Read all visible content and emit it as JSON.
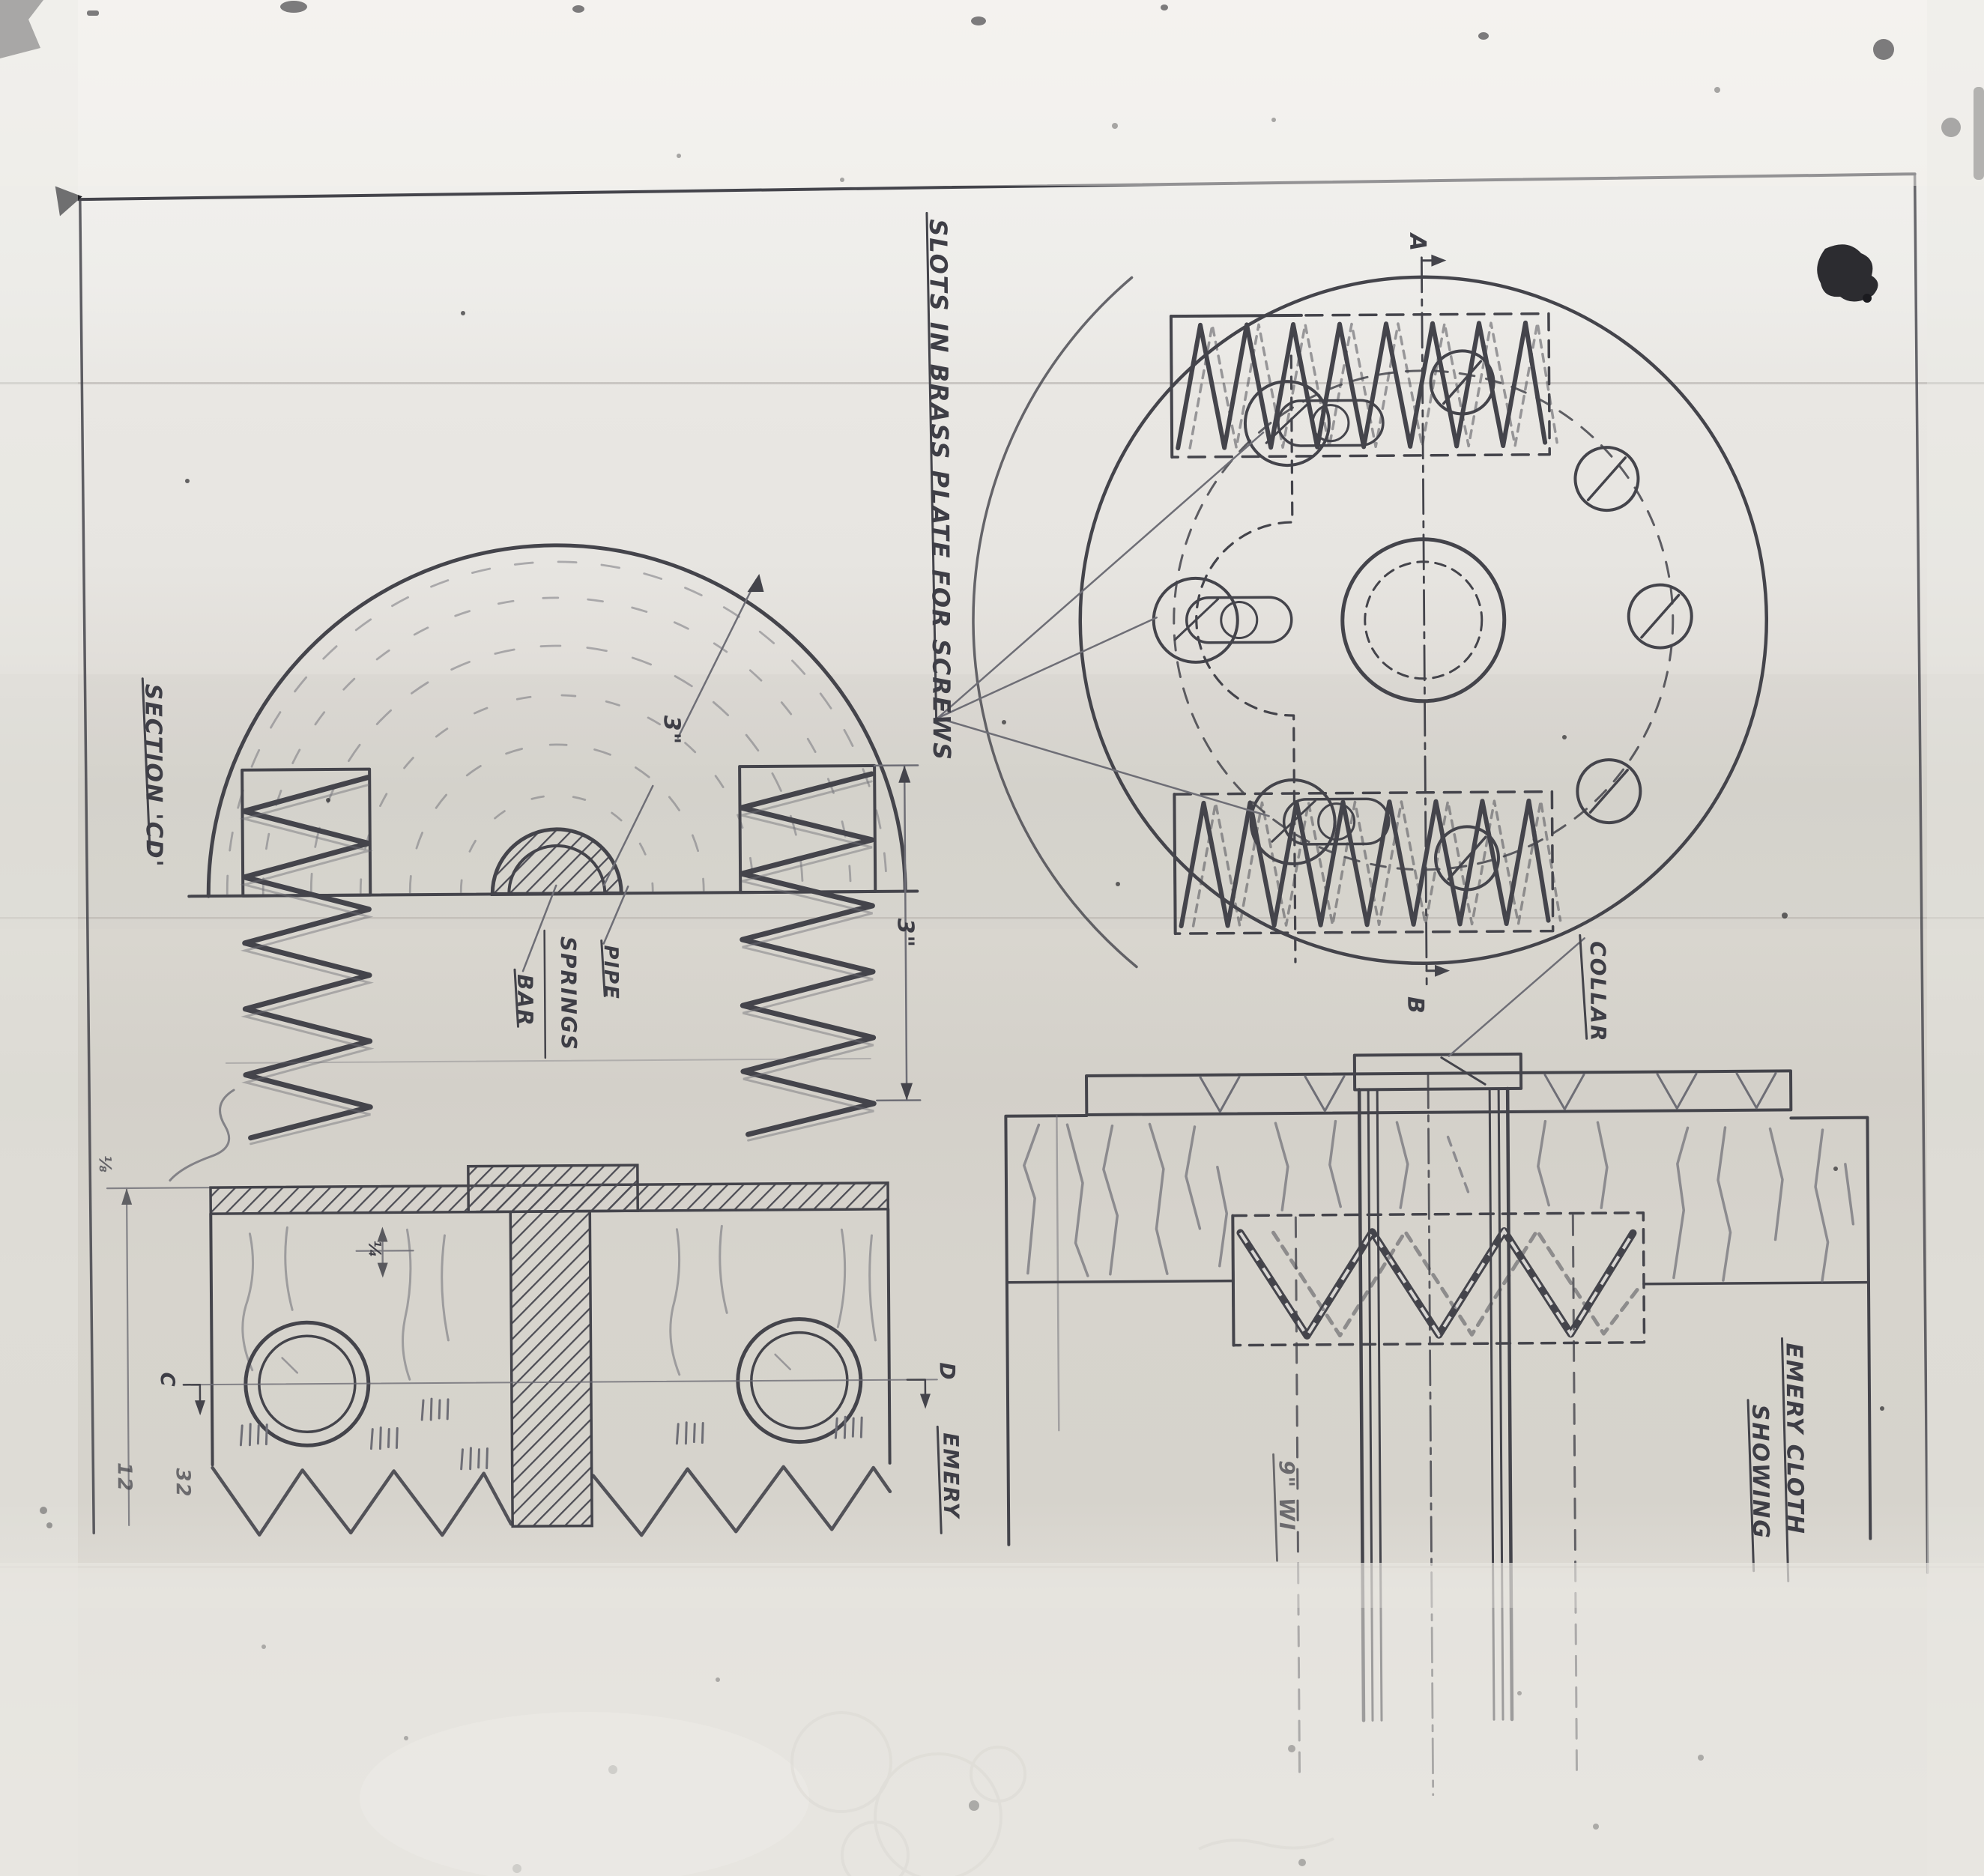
{
  "drawing": {
    "labels": {
      "slots_note": "SLOTS IN BRASS PLATE FOR SCREWS",
      "section_cd": "SECTION 'CD'",
      "bar": "BAR",
      "springs": "SPRINGS",
      "pipe": "PIPE",
      "collar": "COLLAR",
      "emery": "EMERY",
      "emery_cloth": "EMERY CLOTH",
      "showing": "SHOWING",
      "nine_wide": "9\" WI"
    },
    "dimensions": {
      "dome_radius": "3\"",
      "spring_height": "3\"",
      "quarter": "¼",
      "eighth": "⅛",
      "margin_num_1": "12",
      "margin_num_2": "32"
    },
    "section_letters": {
      "a": "A",
      "b": "B",
      "c": "C",
      "d": "D"
    },
    "colors": {
      "ink": "#44444b",
      "ink_light": "#6e6e76",
      "paper_top": "#f3f2ee",
      "paper_mid": "#dedbd5",
      "paper_band": "#d7d4ce",
      "paper_outside": "#e7e5e0"
    }
  }
}
